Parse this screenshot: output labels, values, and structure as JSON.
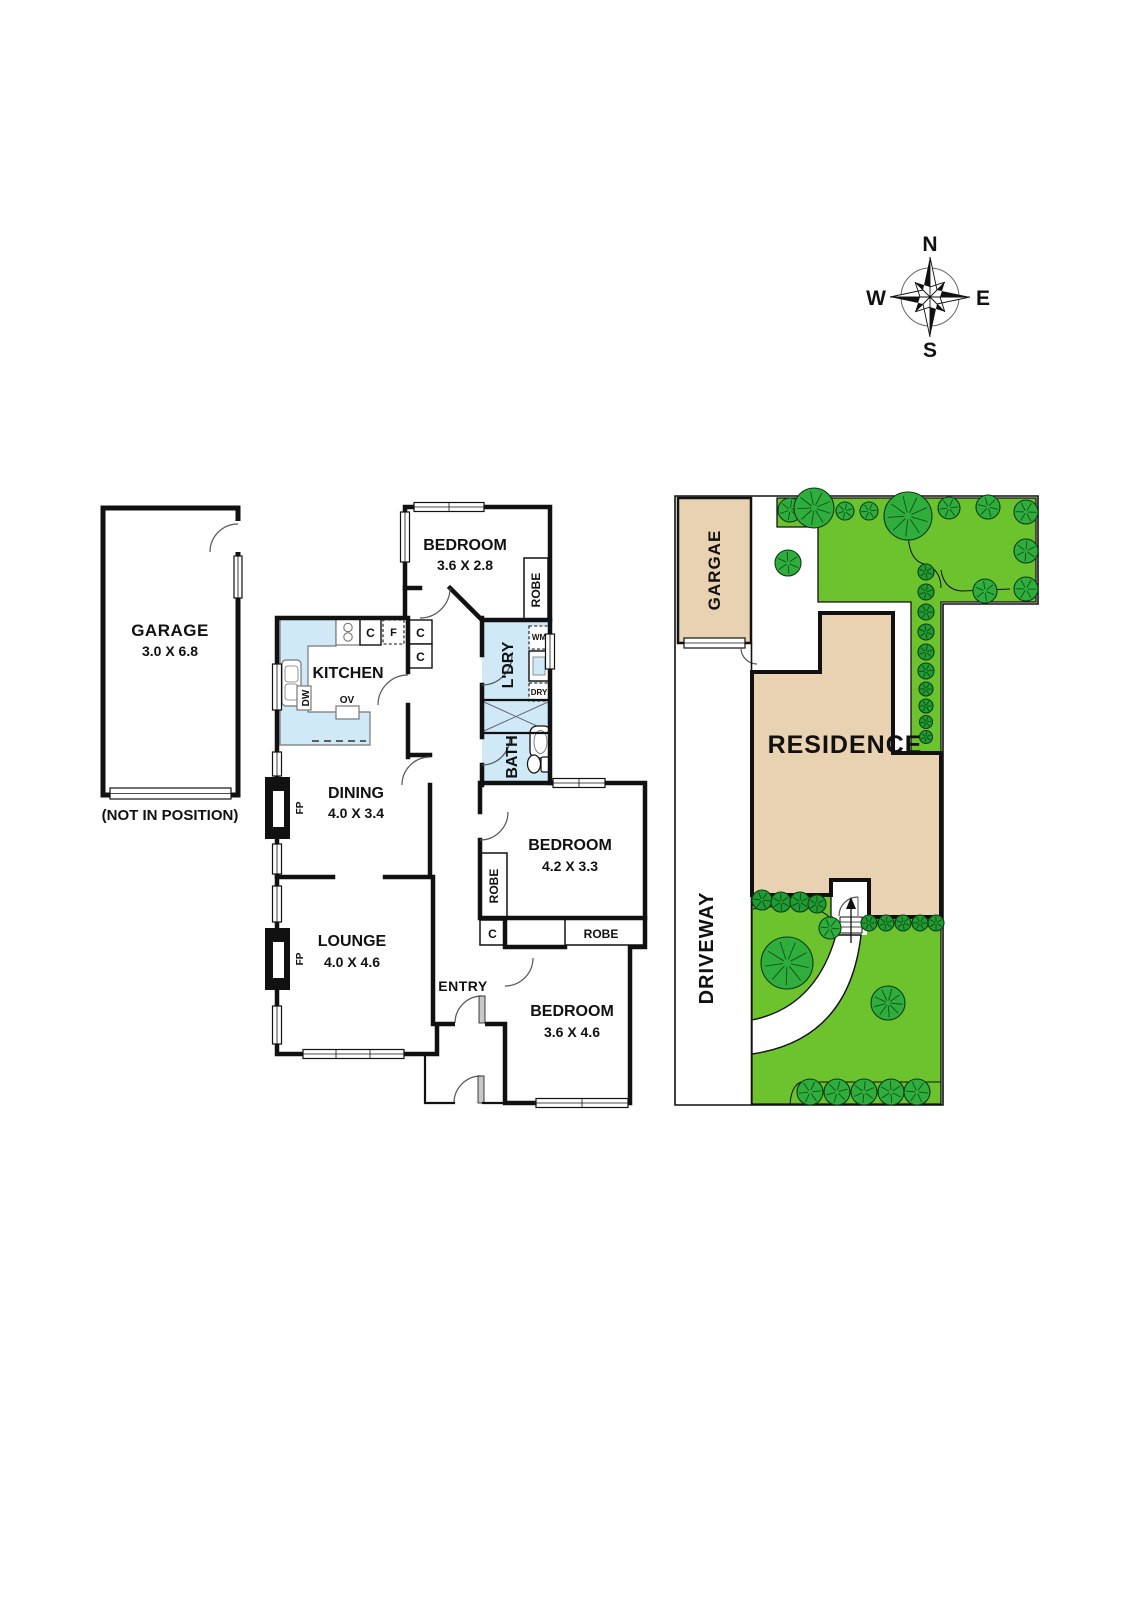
{
  "compass": {
    "n": "N",
    "e": "E",
    "s": "S",
    "w": "W"
  },
  "floorplan": {
    "garage": {
      "name": "GARAGE",
      "dims": "3.0 X 6.8",
      "note": "(NOT IN POSITION)"
    },
    "bedroom1": {
      "name": "BEDROOM",
      "dims": "3.6 X 2.8"
    },
    "bedroom2": {
      "name": "BEDROOM",
      "dims": "4.2 X 3.3"
    },
    "bedroom3": {
      "name": "BEDROOM",
      "dims": "3.6 X 4.6"
    },
    "kitchen": {
      "name": "KITCHEN"
    },
    "laundry": {
      "name": "L'DRY"
    },
    "bath": {
      "name": "BATH"
    },
    "dining": {
      "name": "DINING",
      "dims": "4.0 X 3.4"
    },
    "lounge": {
      "name": "LOUNGE",
      "dims": "4.0 X 4.6"
    },
    "entry": {
      "name": "ENTRY"
    },
    "labels": {
      "robe": "ROBE",
      "cupboard": "C",
      "fridge": "F",
      "washer": "WM",
      "dryer": "DRY",
      "dishwasher": "DW",
      "oven": "OV",
      "fireplace": "FP"
    }
  },
  "siteplan": {
    "garage": "GARGAE",
    "residence": "RESIDENCE",
    "driveway": "DRIVEWAY",
    "vegetation": [
      {
        "x": 790,
        "y": 510,
        "r": 12,
        "kind": "tree"
      },
      {
        "x": 814,
        "y": 508,
        "r": 20,
        "kind": "tree"
      },
      {
        "x": 845,
        "y": 511,
        "r": 9,
        "kind": "tree"
      },
      {
        "x": 869,
        "y": 511,
        "r": 9,
        "kind": "tree"
      },
      {
        "x": 908,
        "y": 516,
        "r": 24,
        "kind": "tree"
      },
      {
        "x": 949,
        "y": 508,
        "r": 11,
        "kind": "tree"
      },
      {
        "x": 988,
        "y": 507,
        "r": 12,
        "kind": "tree"
      },
      {
        "x": 1026,
        "y": 512,
        "r": 12,
        "kind": "tree"
      },
      {
        "x": 1026,
        "y": 551,
        "r": 12,
        "kind": "tree"
      },
      {
        "x": 985,
        "y": 591,
        "r": 12,
        "kind": "tree"
      },
      {
        "x": 1026,
        "y": 589,
        "r": 12,
        "kind": "tree"
      },
      {
        "x": 788,
        "y": 563,
        "r": 13,
        "kind": "tree"
      },
      {
        "x": 926,
        "y": 572,
        "r": 8,
        "kind": "shrub"
      },
      {
        "x": 926,
        "y": 592,
        "r": 8,
        "kind": "shrub"
      },
      {
        "x": 926,
        "y": 612,
        "r": 8,
        "kind": "shrub"
      },
      {
        "x": 926,
        "y": 632,
        "r": 8,
        "kind": "shrub"
      },
      {
        "x": 926,
        "y": 652,
        "r": 8,
        "kind": "shrub"
      },
      {
        "x": 926,
        "y": 671,
        "r": 8,
        "kind": "shrub"
      },
      {
        "x": 926,
        "y": 689,
        "r": 7,
        "kind": "shrub"
      },
      {
        "x": 926,
        "y": 706,
        "r": 7,
        "kind": "shrub"
      },
      {
        "x": 926,
        "y": 722,
        "r": 6.5,
        "kind": "shrub"
      },
      {
        "x": 926,
        "y": 737,
        "r": 6.5,
        "kind": "shrub"
      },
      {
        "x": 762,
        "y": 900,
        "r": 10,
        "kind": "shrub"
      },
      {
        "x": 781,
        "y": 902,
        "r": 10,
        "kind": "shrub"
      },
      {
        "x": 800,
        "y": 902,
        "r": 10,
        "kind": "shrub"
      },
      {
        "x": 817,
        "y": 904,
        "r": 9,
        "kind": "shrub"
      },
      {
        "x": 830,
        "y": 928,
        "r": 11,
        "kind": "tree"
      },
      {
        "x": 869,
        "y": 923,
        "r": 8,
        "kind": "shrub"
      },
      {
        "x": 886,
        "y": 923,
        "r": 8,
        "kind": "shrub"
      },
      {
        "x": 903,
        "y": 923,
        "r": 8,
        "kind": "shrub"
      },
      {
        "x": 920,
        "y": 923,
        "r": 8,
        "kind": "shrub"
      },
      {
        "x": 936,
        "y": 923,
        "r": 8,
        "kind": "shrub"
      },
      {
        "x": 787,
        "y": 963,
        "r": 26,
        "kind": "tree"
      },
      {
        "x": 888,
        "y": 1003,
        "r": 17,
        "kind": "tree"
      },
      {
        "x": 810,
        "y": 1092,
        "r": 13,
        "kind": "tree"
      },
      {
        "x": 837,
        "y": 1092,
        "r": 13,
        "kind": "tree"
      },
      {
        "x": 864,
        "y": 1092,
        "r": 13,
        "kind": "tree"
      },
      {
        "x": 891,
        "y": 1092,
        "r": 13,
        "kind": "tree"
      },
      {
        "x": 917,
        "y": 1092,
        "r": 13,
        "kind": "tree"
      }
    ]
  },
  "palette": {
    "wall": "#111111",
    "wet_area": "#cfe9f6",
    "lawn": "#6cc32e",
    "tree": "#2fad3d",
    "shrub": "#219b33",
    "building": "#e9d2b2"
  }
}
